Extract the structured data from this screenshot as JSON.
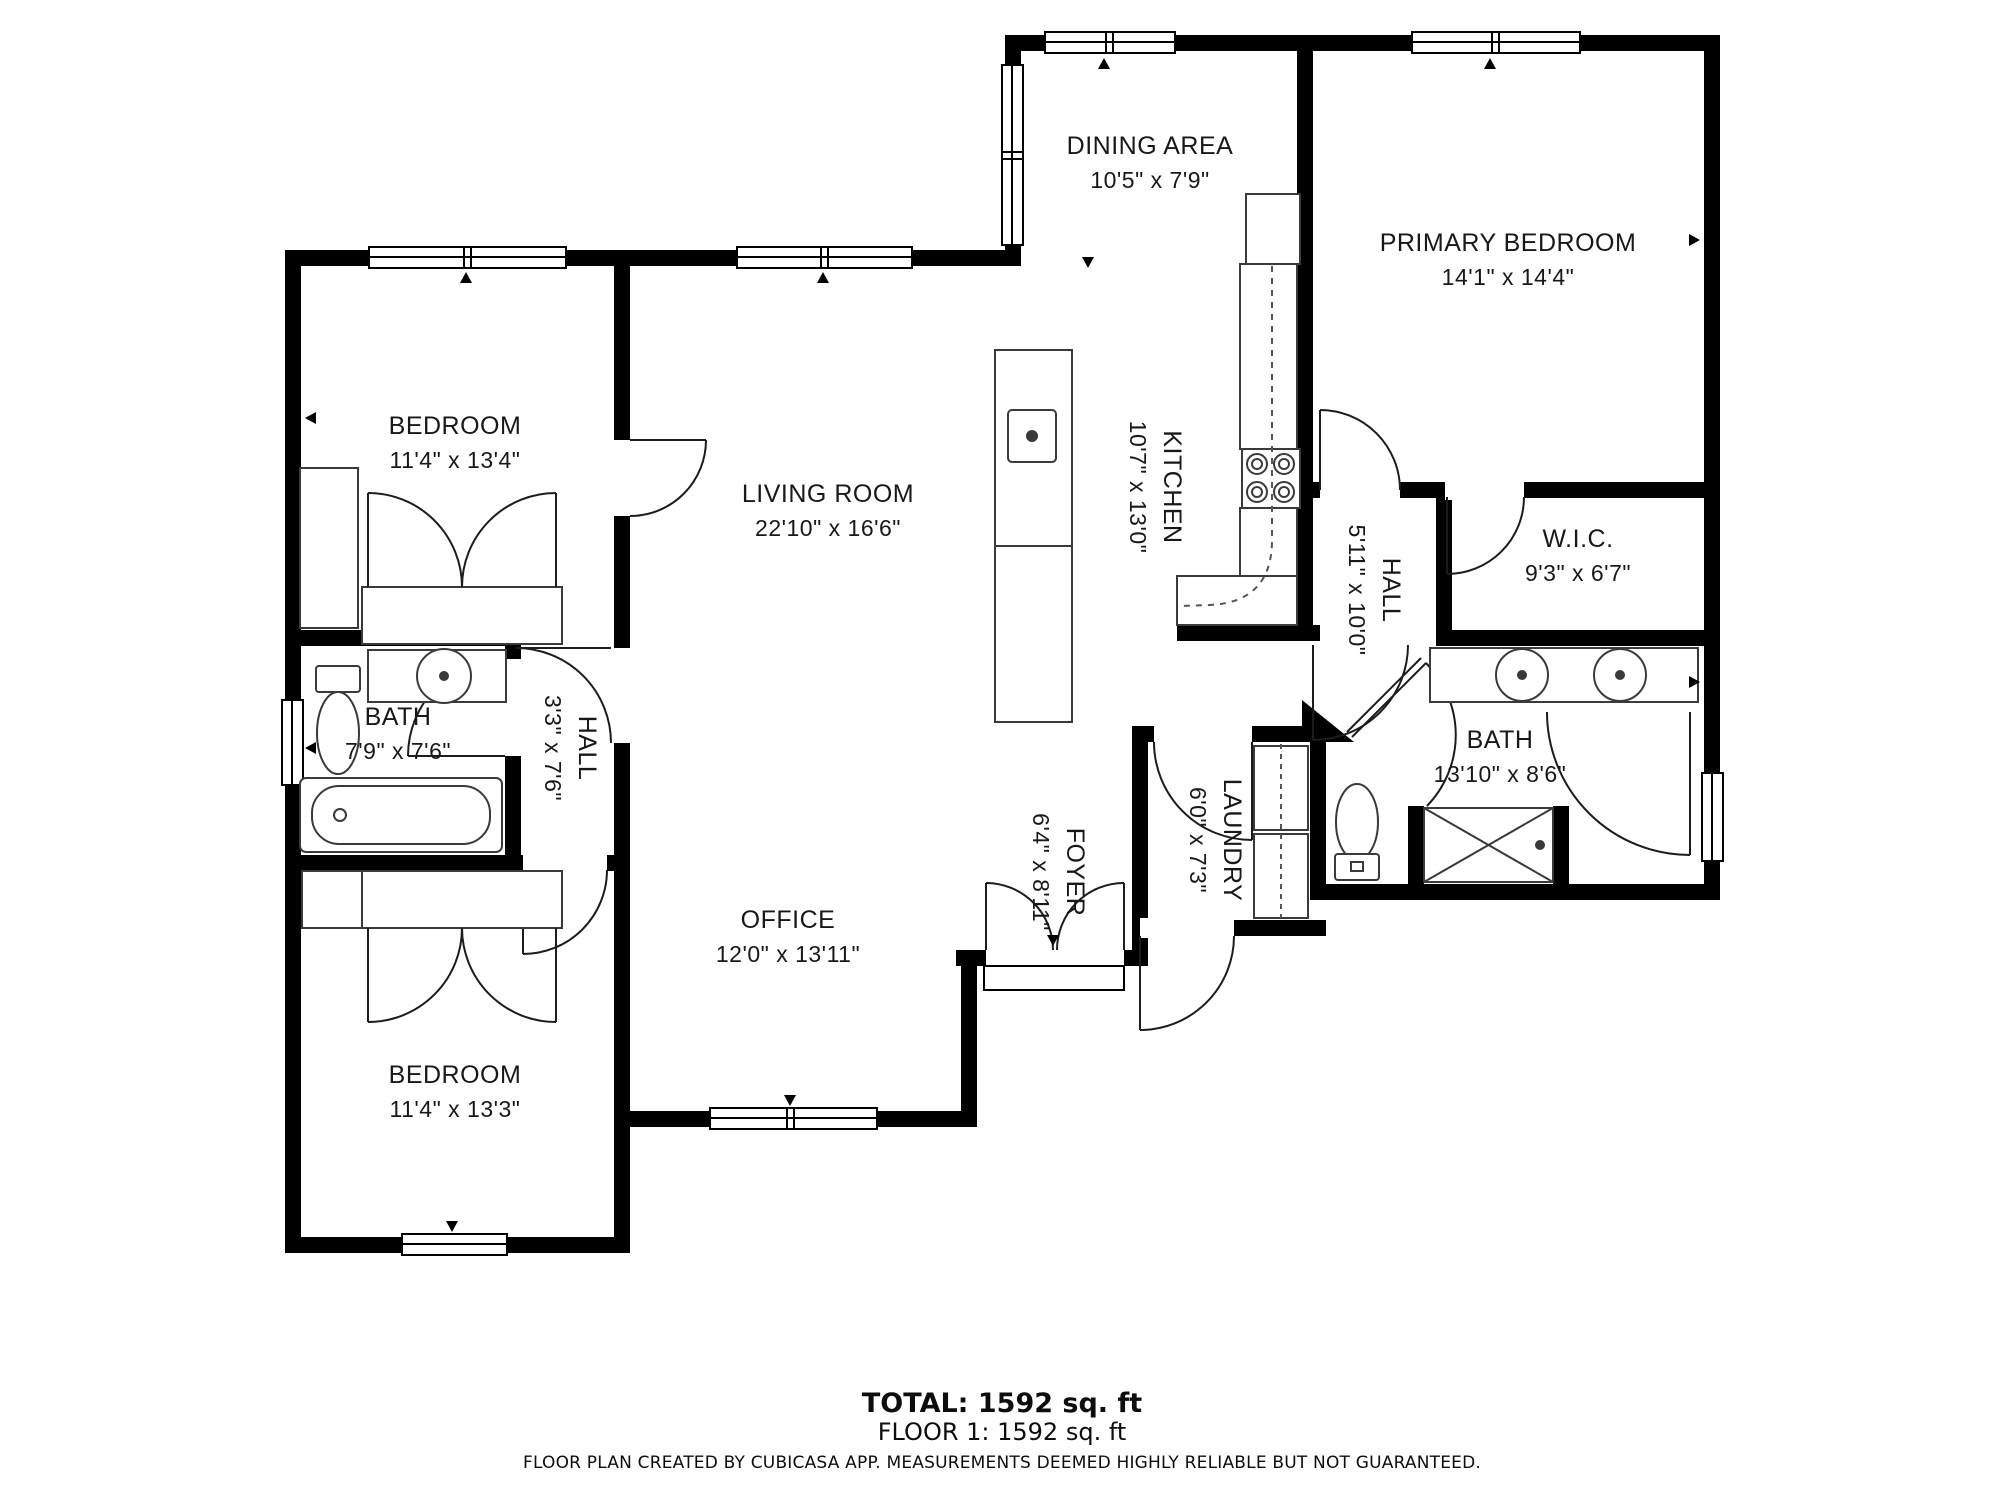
{
  "rooms": [
    {
      "id": "dining-area",
      "name": "DINING AREA",
      "dims": "10'5\" x 7'9\""
    },
    {
      "id": "primary-bedroom",
      "name": "PRIMARY BEDROOM",
      "dims": "14'1\" x 14'4\""
    },
    {
      "id": "bedroom-top",
      "name": "BEDROOM",
      "dims": "11'4\" x 13'4\""
    },
    {
      "id": "living-room",
      "name": "LIVING ROOM",
      "dims": "22'10\" x 16'6\""
    },
    {
      "id": "kitchen",
      "name": "KITCHEN",
      "dims": "10'7\" x 13'0\""
    },
    {
      "id": "hall-upper",
      "name": "HALL",
      "dims": "5'11\" x 10'0\""
    },
    {
      "id": "wic",
      "name": "W.I.C.",
      "dims": "9'3\" x 6'7\""
    },
    {
      "id": "bath-left",
      "name": "BATH",
      "dims": "7'9\" x 7'6\""
    },
    {
      "id": "hall-lower",
      "name": "HALL",
      "dims": "3'3\" x 7'6\""
    },
    {
      "id": "bath-right",
      "name": "BATH",
      "dims": "13'10\" x 8'6\""
    },
    {
      "id": "foyer",
      "name": "FOYER",
      "dims": "6'4\" x 8'11\""
    },
    {
      "id": "laundry",
      "name": "LAUNDRY",
      "dims": "6'0\" x 7'3\""
    },
    {
      "id": "office",
      "name": "OFFICE",
      "dims": "12'0\" x 13'11\""
    },
    {
      "id": "bedroom-bottom",
      "name": "BEDROOM",
      "dims": "11'4\" x 13'3\""
    }
  ],
  "summary": {
    "total": "TOTAL: 1592 sq. ft",
    "floor": "FLOOR 1: 1592 sq. ft"
  },
  "footer": {
    "disclaimer": "FLOOR PLAN CREATED BY CUBICASA APP. MEASUREMENTS DEEMED HIGHLY RELIABLE BUT NOT GUARANTEED."
  },
  "colors": {
    "wall": "#000000",
    "fixture_line": "#3a3a3a",
    "text": "#181818"
  }
}
